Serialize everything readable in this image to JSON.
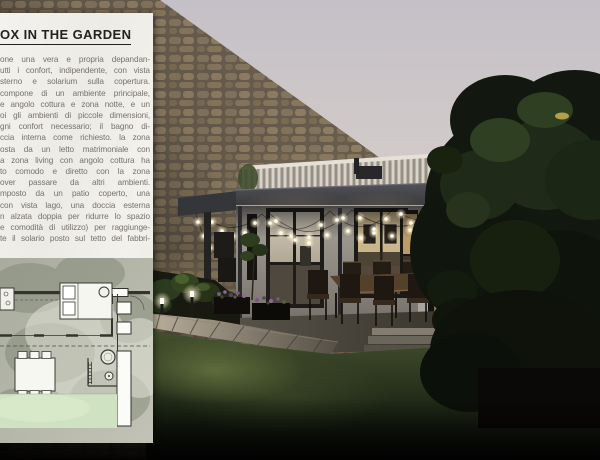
{
  "panel": {
    "title": "OX IN THE GARDEN",
    "paragraph_lines": [
      "one una vera e propria depandan-",
      "utti i confort, indipendente, con vista",
      "sterno e solarium sulla copertura.",
      "compone di un ambiente principale,",
      "e angolo cottura e zona notte, e un",
      "oi gli ambienti di piccole dimensioni,",
      "gni confort necessario; il bagno di-",
      "ccia interna come richiesto. la zona",
      "osta da un letto matrimoniale con",
      "a zona living con angolo cottura ha",
      "to comodo e diretto con la zona",
      "over passare da altri ambienti.",
      "mposto da un patio coperto, una",
      "con vista lago, una doccia esterna",
      "n alzata doppia per ridurre lo spazio",
      "e comodità di utilizzo) per raggiunge-",
      "te il solario posto sul tetto del fabbri-"
    ]
  },
  "colors": {
    "panel_bg": "#f2f0ec",
    "sky_top": "#c4c0c7",
    "sky_horizon": "#ddd3c9",
    "stone": "#8c7c64",
    "canopy": "#3d3e40",
    "string_light": "#fff6dc",
    "lawn": "#35422a",
    "plan_lawn": "#cfe3c2"
  }
}
